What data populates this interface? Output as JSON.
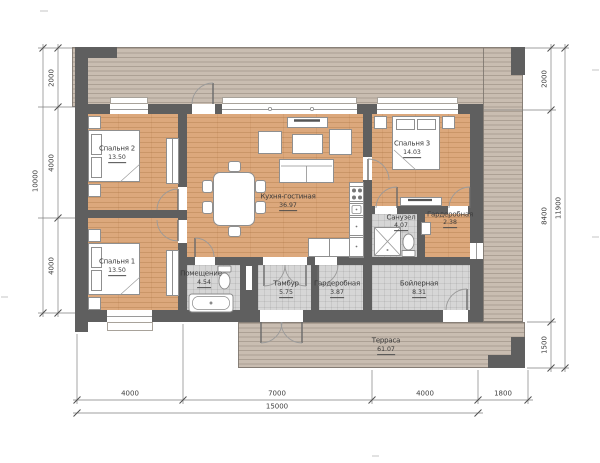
{
  "plan_type": "house-floor-plan",
  "rooms": [
    {
      "id": "bedroom2",
      "name": "Спальня 2",
      "area": "13.50"
    },
    {
      "id": "bedroom1",
      "name": "Спальня 1",
      "area": "13.50"
    },
    {
      "id": "bedroom3",
      "name": "Спальня 3",
      "area": "14.03"
    },
    {
      "id": "kitchen_living",
      "name": "Кухня-гостиная",
      "area": "36.97"
    },
    {
      "id": "bathroom",
      "name": "Санузел",
      "area": "4.07"
    },
    {
      "id": "wardrobe_master",
      "name": "Гардеробная",
      "area": "2.38"
    },
    {
      "id": "utility",
      "name": "Помещение",
      "area": "4.54"
    },
    {
      "id": "vestibule",
      "name": "Тамбур",
      "area": "5.75"
    },
    {
      "id": "wardrobe_entry",
      "name": "Гардеробная",
      "area": "3.87"
    },
    {
      "id": "boiler",
      "name": "Бойлерная",
      "area": "8.31"
    },
    {
      "id": "terrace",
      "name": "Терраса",
      "area": "61.07"
    }
  ],
  "dimensions": {
    "left": {
      "segments": [
        "2000",
        "4000",
        "4000"
      ],
      "total": "10000"
    },
    "right": {
      "segments": [
        "2000",
        "8400",
        "1500"
      ],
      "total": "11900"
    },
    "bottom": {
      "segments": [
        "4000",
        "7000",
        "4000",
        "1800"
      ],
      "total": "15000"
    }
  },
  "colors": {
    "wall": "#5f5f5f",
    "wood_floor": "#dca87c",
    "deck": "#c9bdb1",
    "tile_floor": "#d6d6d6"
  }
}
